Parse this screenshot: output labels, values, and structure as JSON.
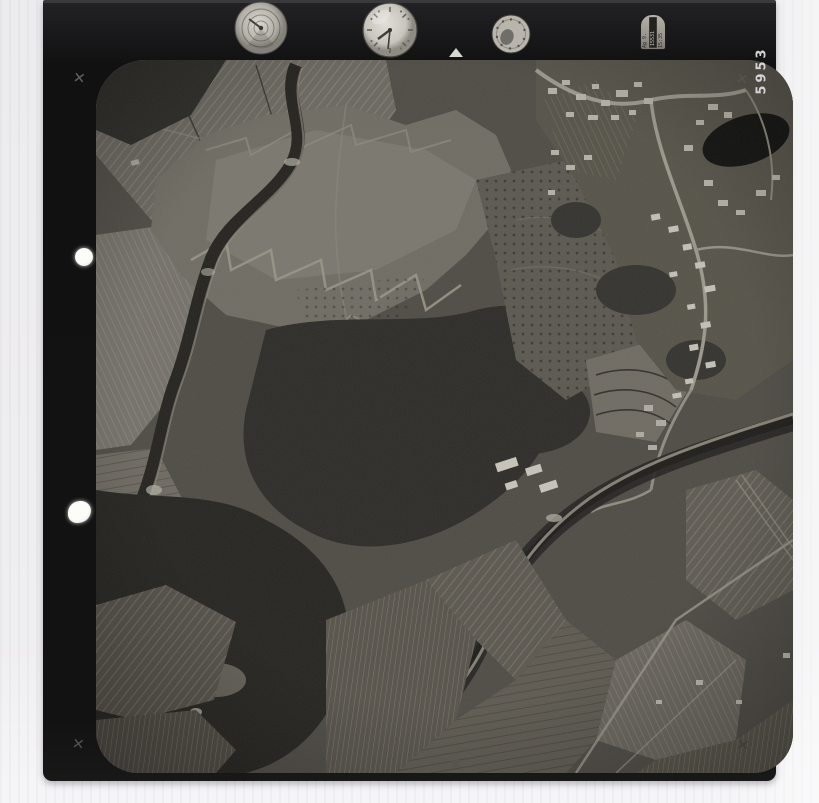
{
  "palette": {
    "background": "#edecee",
    "film": "#141414",
    "photo_dark": "#2c2b28",
    "photo_mid": "#55524c",
    "photo_light": "#a5a199",
    "dial_face": "#d4d1c9",
    "frame_number_color": "#d3d3d7"
  },
  "film_edge": {
    "frame_number": "5953"
  },
  "instrument_panel": {
    "data_plate": {
      "line1": "Ag 9.",
      "line2": "15531",
      "line3": "15:35"
    }
  }
}
